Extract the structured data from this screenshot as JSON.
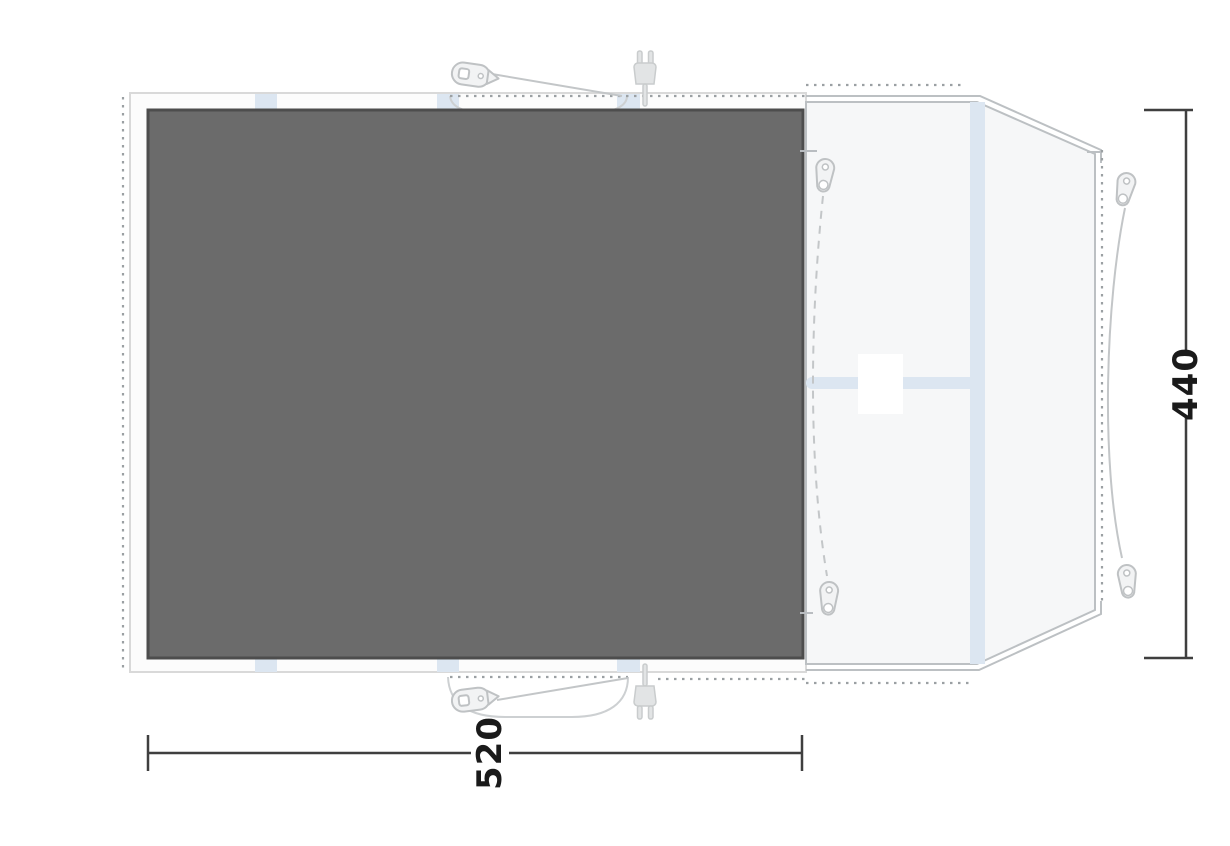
{
  "page": {
    "background": "#ffffff"
  },
  "diagram": {
    "name": "tent-footprint-groundsheet-top-view",
    "dimension_width": {
      "value": "520"
    },
    "dimension_height": {
      "value": "440"
    },
    "colors": {
      "groundsheet_fill": "#6b6b6b",
      "groundsheet_border": "#4d4d4d",
      "footprint_fill": "#fcfcfc",
      "footprint_border": "#d9d9d9",
      "tent_fill": "#f6f7f8",
      "tent_outline": "#bcc0c3",
      "pole_band": "#dce6f1",
      "guide_dots": "#9ba0a3",
      "accessory_outline": "#c3c6c8",
      "accessory_fill": "#f2f3f4",
      "plug_fill": "#e2e4e5",
      "dimension_line": "#3f3f3f",
      "dimension_text": "#1a1a1a"
    },
    "icons": [
      "zipper-pull-icon",
      "power-plug-icon"
    ]
  }
}
